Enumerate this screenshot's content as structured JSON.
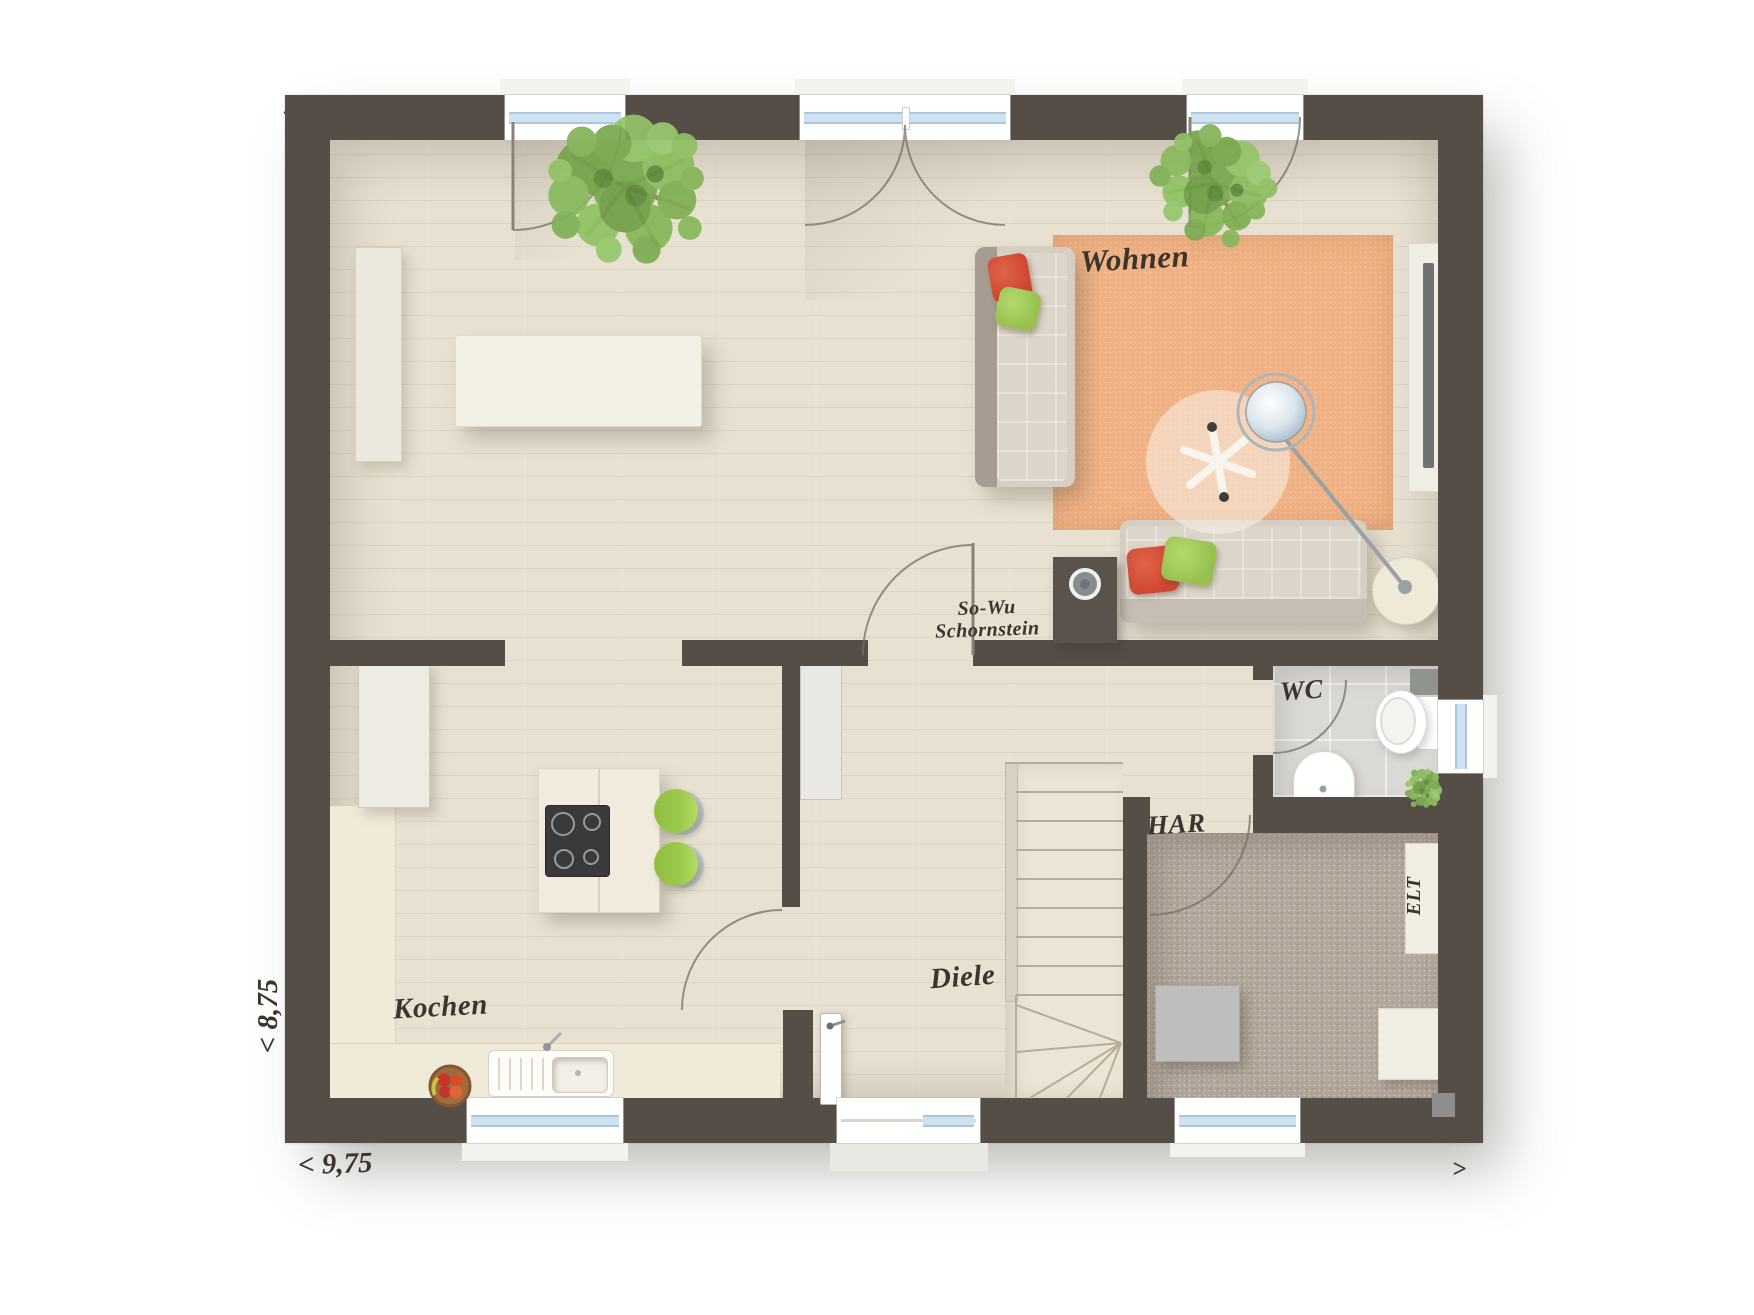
{
  "plan": {
    "labels": {
      "wohnen": "Wohnen",
      "kochen": "Kochen",
      "diele": "Diele",
      "wc": "WC",
      "har": "HAR",
      "elt": "ELT",
      "so_wu": "So-Wu",
      "schornstein": "Schornstein"
    },
    "dimensions": {
      "width": "< 9,75",
      "height": "< 8,75"
    },
    "compass": {
      "top_left": "∧",
      "bottom_right": ">"
    }
  },
  "colors": {
    "wall": "#554e46",
    "floor": "#e8e1d1",
    "stairs_floor": "#ece5d5",
    "rug": "#f0b184",
    "wc_tile": "#dbd9d5",
    "har_carpet": "#b3a79c",
    "counter": "#f0ead9",
    "island": "#f0ebdc",
    "table": "#f2efe5",
    "chair_green": "#97c445",
    "stool_green": "#9cc94d",
    "sofa": "#d6cec3",
    "sofa_trim": "#a79c91",
    "pillow_red": "#cf4630",
    "pillow_green": "#97c04f",
    "glass": "#cfe2ef",
    "glass_frame": "#a9c7dd",
    "label_ink": "#3b352e",
    "lamp_metal": "#9aa1a6"
  }
}
